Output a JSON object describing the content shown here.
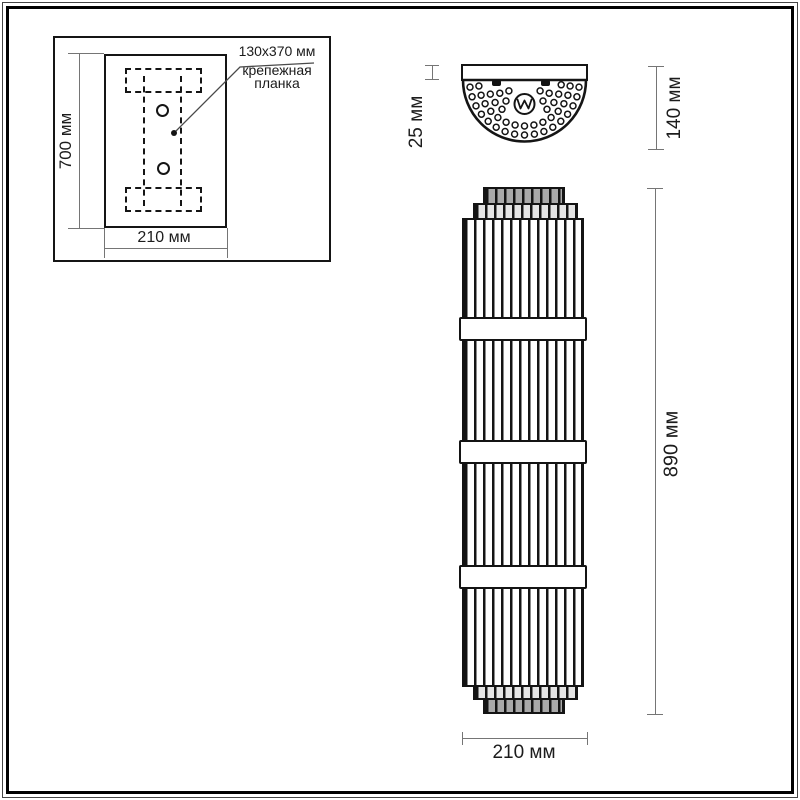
{
  "drawing": {
    "line_color": "#151515",
    "dim_color": "#757575",
    "inset": {
      "height": "700 мм",
      "width": "210 мм",
      "callout_size": "130x370 мм",
      "callout_name_line1": "крепежная",
      "callout_name_line2": "планка"
    },
    "top_view": {
      "depth": "25 мм",
      "width": "140 мм"
    },
    "front_view": {
      "height": "890 мм",
      "width": "210 мм"
    }
  }
}
